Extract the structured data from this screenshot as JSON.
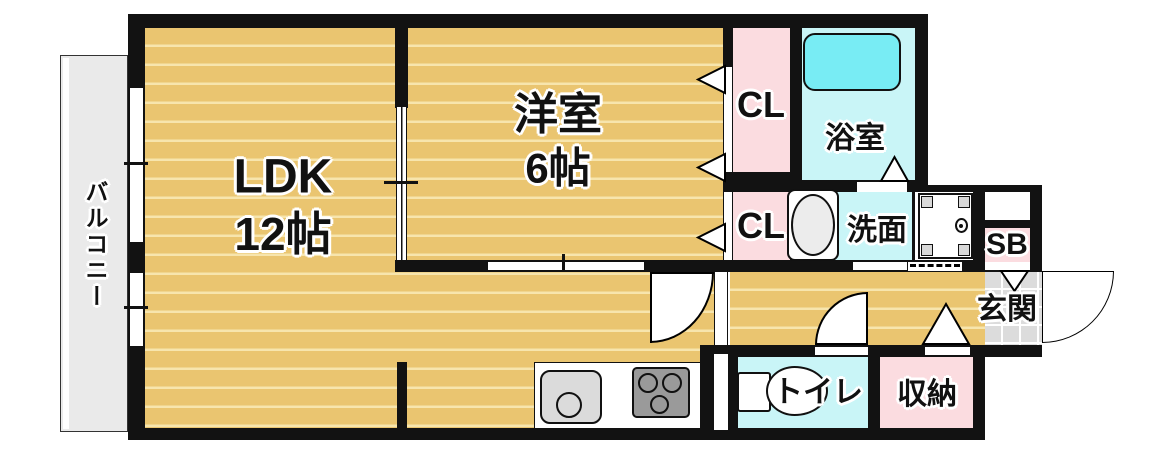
{
  "plan_title": "1LDK floor plan",
  "colors": {
    "wall": "#121212",
    "tatami_floor": "#EAC570",
    "tatami_stripe": "#F7E5AD",
    "closet_pink": "#FBDCE0",
    "wet_area_cyan": "#C9F5F7",
    "bathtub_cyan": "#78ECF4",
    "entrance_tile_gray": "#DCDCDC",
    "balcony_gray": "#EAEAEA"
  },
  "rooms": {
    "balcony": {
      "label": "バルコニー"
    },
    "ldk": {
      "name": "LDK",
      "size": "12帖"
    },
    "western_room": {
      "name": "洋室",
      "size": "6帖"
    },
    "closet_upper": {
      "label": "CL"
    },
    "closet_lower": {
      "label": "CL"
    },
    "bathroom": {
      "label": "浴室"
    },
    "washroom": {
      "label": "洗面"
    },
    "shoe_box": {
      "label": "SB"
    },
    "entrance": {
      "label": "玄関"
    },
    "toilet": {
      "label": "トイレ"
    },
    "storage": {
      "label": "収納"
    }
  }
}
